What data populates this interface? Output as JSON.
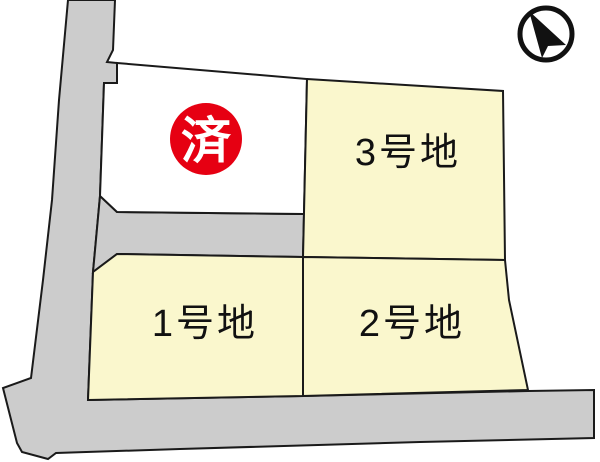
{
  "diagram": {
    "kind": "land-lot-layout",
    "lots": [
      {
        "id": "lot-1",
        "label": "1号地",
        "status": "for-sale"
      },
      {
        "id": "lot-2",
        "label": "2号地",
        "status": "for-sale"
      },
      {
        "id": "lot-3",
        "label": "3号地",
        "status": "for-sale"
      },
      {
        "id": "lot-sold",
        "label": "",
        "status": "sold"
      }
    ],
    "sold_badge": {
      "text": "済"
    },
    "colors": {
      "lot_fill": "#faf7cd",
      "sold_lot_fill": "#ffffff",
      "road_fill": "#cccccc",
      "line": "#1a1a1a",
      "badge_fill": "#e60012",
      "badge_text": "#ffffff",
      "compass": "#111111"
    }
  }
}
